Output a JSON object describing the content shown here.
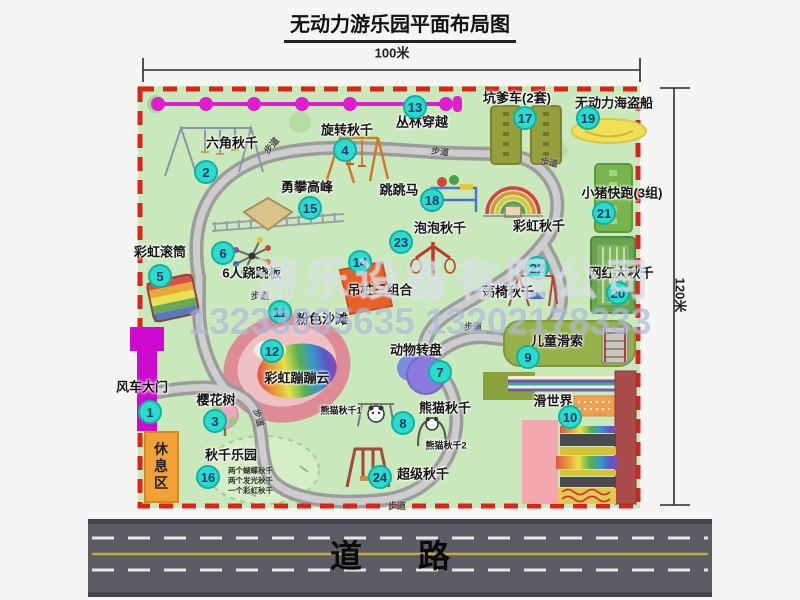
{
  "title": "无动力游乐园平面布局图",
  "dimensions": {
    "width_label": "100米",
    "height_label": "120米"
  },
  "road": {
    "label": "道路"
  },
  "rest_area": {
    "label": "休息区"
  },
  "watermark": {
    "company": "游乐设备有限公司",
    "phone": "13233805635 13202178333"
  },
  "colors": {
    "park_green": "#c9e8bb",
    "border_red": "#dc2318",
    "badge_teal": "#2bdccd",
    "gate_magenta": "#cf0ad0",
    "zipline_magenta": "#e01ed0",
    "rest_orange": "#f0a238",
    "road_gray": "#5c5c64",
    "road_yellow": "#c8a83c"
  },
  "attractions": [
    {
      "num": "1",
      "name": "风车大门",
      "bx": 150,
      "by": 412,
      "lx": 142,
      "ly": 387
    },
    {
      "num": "2",
      "name": "六角秋千",
      "bx": 206,
      "by": 172,
      "lx": 232,
      "ly": 143
    },
    {
      "num": "3",
      "name": "樱花树",
      "bx": 215,
      "by": 421,
      "lx": 216,
      "ly": 400
    },
    {
      "num": "4",
      "name": "旋转秋千",
      "bx": 345,
      "by": 150,
      "lx": 347,
      "ly": 130
    },
    {
      "num": "5",
      "name": "彩虹滚筒",
      "bx": 160,
      "by": 276,
      "lx": 160,
      "ly": 252
    },
    {
      "num": "6",
      "name": "6人跷跷板",
      "bx": 223,
      "by": 253,
      "lx": 252,
      "ly": 273
    },
    {
      "num": "7",
      "name": "动物转盘",
      "bx": 440,
      "by": 372,
      "lx": 416,
      "ly": 350
    },
    {
      "num": "8",
      "name": "熊猫秋千",
      "bx": 403,
      "by": 423,
      "lx": 445,
      "ly": 408
    },
    {
      "num": "9",
      "name": "儿童滑索",
      "bx": 528,
      "by": 357,
      "lx": 557,
      "ly": 341
    },
    {
      "num": "10",
      "name": "滑世界",
      "bx": 570,
      "by": 417,
      "lx": 553,
      "ly": 401
    },
    {
      "num": "11",
      "name": "粉色沙滩",
      "bx": 280,
      "by": 312,
      "lx": 322,
      "ly": 319
    },
    {
      "num": "12",
      "name": "彩虹蹦蹦云",
      "bx": 272,
      "by": 351,
      "lx": 297,
      "ly": 378
    },
    {
      "num": "13",
      "name": "丛林穿越",
      "bx": 415,
      "by": 107,
      "lx": 422,
      "ly": 122
    },
    {
      "num": "14",
      "name": "吊桩三组合",
      "bx": 360,
      "by": 262,
      "lx": 380,
      "ly": 290
    },
    {
      "num": "15",
      "name": "勇攀高峰",
      "bx": 310,
      "by": 208,
      "lx": 307,
      "ly": 187
    },
    {
      "num": "16",
      "name": "秋千乐园",
      "bx": 208,
      "by": 477,
      "lx": 231,
      "ly": 455
    },
    {
      "num": "17",
      "name": "坑爹车(2套)",
      "bx": 525,
      "by": 118,
      "lx": 517,
      "ly": 98
    },
    {
      "num": "18",
      "name": "跳跳马",
      "bx": 432,
      "by": 200,
      "lx": 399,
      "ly": 190
    },
    {
      "num": "19",
      "name": "无动力海盗船",
      "bx": 588,
      "by": 118,
      "lx": 614,
      "ly": 103
    },
    {
      "num": "20",
      "name": "网红大秋千",
      "bx": 618,
      "by": 293,
      "lx": 621,
      "ly": 273
    },
    {
      "num": "21",
      "name": "小猪快跑(3组)",
      "bx": 604,
      "by": 213,
      "lx": 622,
      "ly": 193
    },
    {
      "num": "22",
      "name": "荡椅秋千",
      "bx": 537,
      "by": 268,
      "lx": 508,
      "ly": 292
    },
    {
      "num": "23",
      "name": "泡泡秋千",
      "bx": 401,
      "by": 242,
      "lx": 440,
      "ly": 228
    },
    {
      "num": "24",
      "name": "超级秋千",
      "bx": 380,
      "by": 477,
      "lx": 423,
      "ly": 474
    }
  ],
  "extra_labels": [
    {
      "text": "彩虹秋千",
      "x": 539,
      "y": 226,
      "size": "normal"
    },
    {
      "text": "熊猫秋千1",
      "x": 341,
      "y": 411,
      "size": "small"
    },
    {
      "text": "熊猫秋千2",
      "x": 446,
      "y": 446,
      "size": "small"
    }
  ],
  "swing_park_sublabels": [
    "两个蝴蝶秋千",
    "两个发光秋千",
    "一个彩虹秋千"
  ],
  "path_labels": [
    {
      "text": "步道",
      "x": 272,
      "y": 146,
      "rot": -50
    },
    {
      "text": "步道",
      "x": 440,
      "y": 152,
      "rot": 8
    },
    {
      "text": "步道",
      "x": 549,
      "y": 163,
      "rot": 10
    },
    {
      "text": "步道",
      "x": 251,
      "y": 292,
      "rot": 0
    },
    {
      "text": "步道",
      "x": 258,
      "y": 418,
      "rot": 75
    },
    {
      "text": "步道",
      "x": 388,
      "y": 502,
      "rot": 0
    },
    {
      "text": "步道",
      "x": 464,
      "y": 323,
      "rot": 0
    }
  ]
}
